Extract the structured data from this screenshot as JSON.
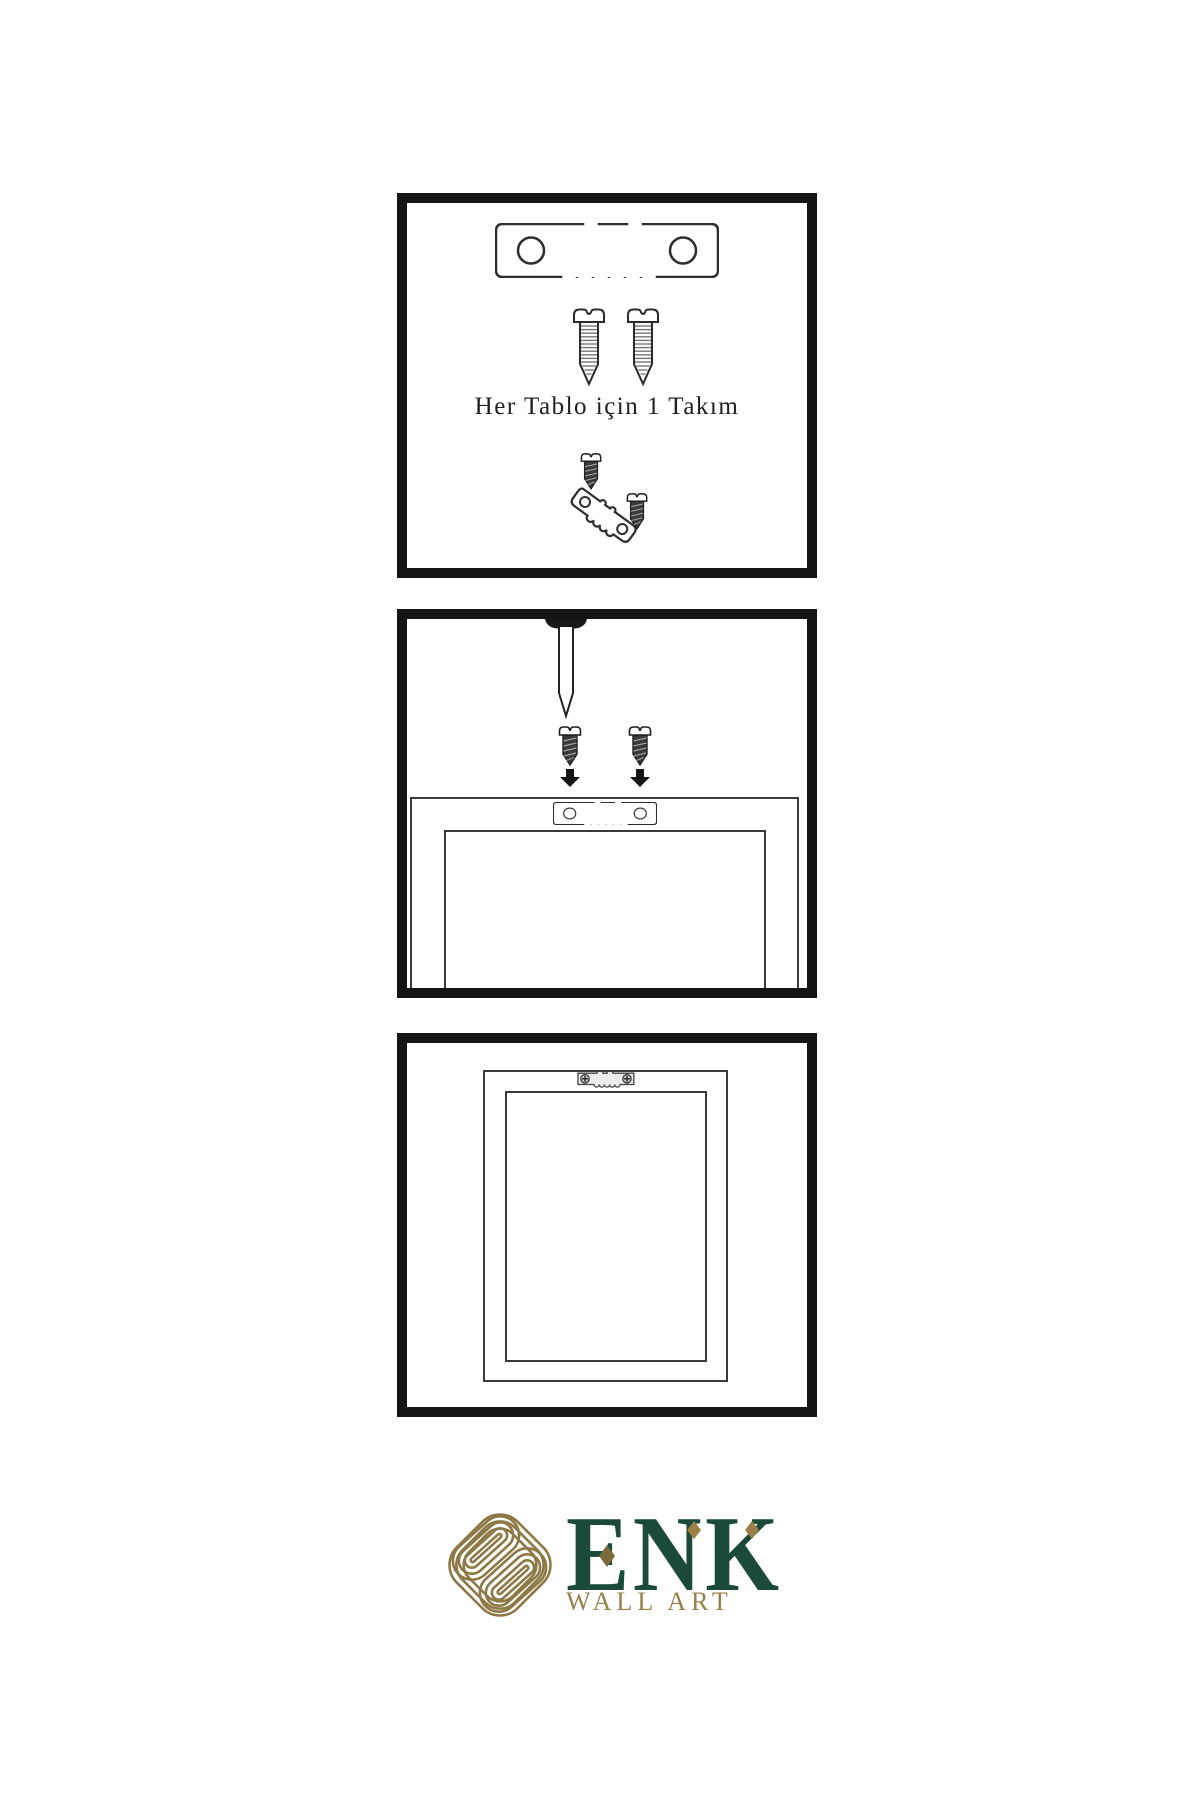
{
  "meta": {
    "background": "#ffffff",
    "line_ink": "#2e2e2e",
    "panel_border": "#141414"
  },
  "panels": [
    {
      "id": "hardware-kit",
      "caption": "Her Tablo için 1 Takım",
      "items": [
        "sawtooth-hanger-icon",
        "screw-icon",
        "screw-icon",
        "screw-into-hanger-assembly-icon"
      ]
    },
    {
      "id": "nail-and-screws-to-frame-back",
      "items": [
        "wall-nail-icon",
        "dark-screw-icon",
        "dark-screw-icon",
        "down-arrow-icon",
        "down-arrow-icon",
        "frame-back-icon",
        "sawtooth-hanger-icon"
      ]
    },
    {
      "id": "hanger-mounted-on-frame-back",
      "items": [
        "frame-back-icon",
        "mounted-sawtooth-hanger-icon"
      ]
    }
  ],
  "brand": {
    "emblem": "knot-emblem-icon",
    "name": "ENK",
    "tagline": "WALL ART",
    "accent_shape": "diamond",
    "green": "#1c4a39",
    "gold": "#97814a",
    "emblem_gold": "#8d7945"
  }
}
